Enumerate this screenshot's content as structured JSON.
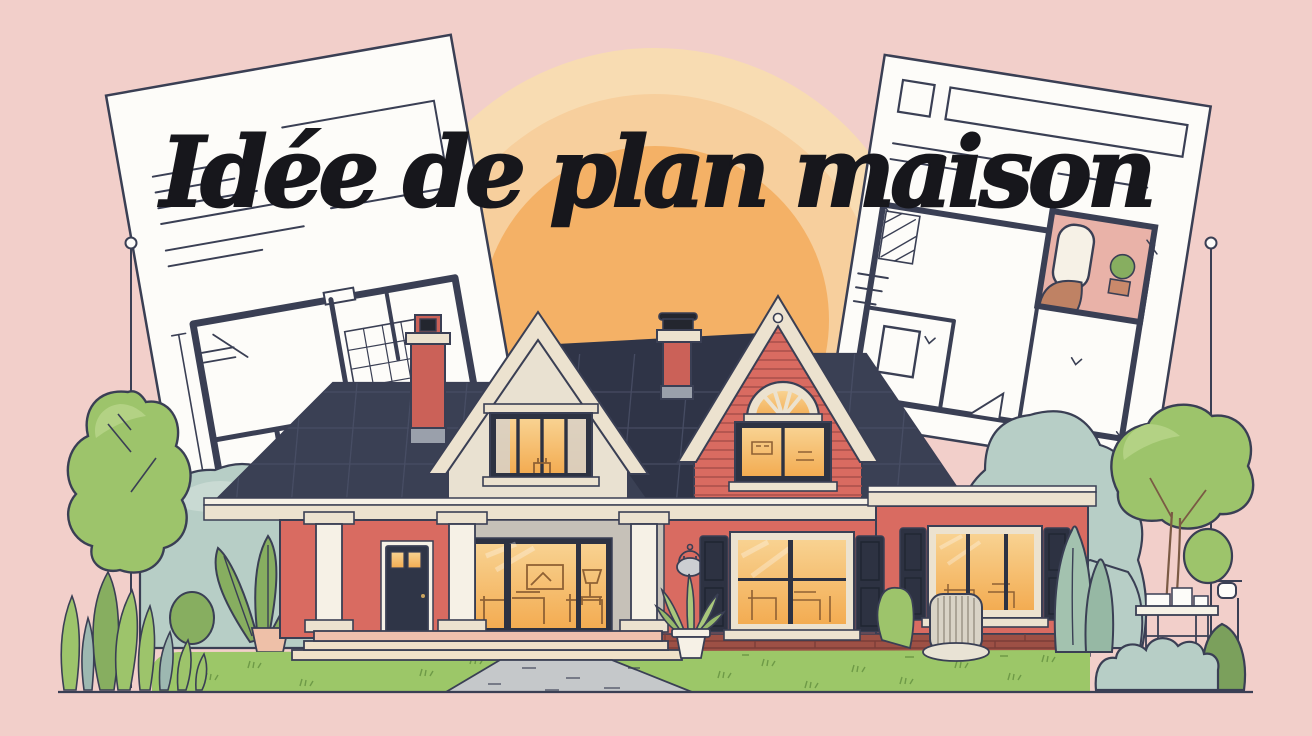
{
  "title": {
    "text": "Idée de plan maison"
  },
  "palette": {
    "bg": "#f2cfca",
    "sun1": "#f8dcb2",
    "sun2": "#f7cf9d",
    "sun3": "#f4b166",
    "ink": "#3a3f54",
    "paper": "#fdfcf9",
    "roof": "#3a4054",
    "roof_dark": "#2f3447",
    "roof_line": "#4b5168",
    "cream": "#ece2cf",
    "cream_light": "#f6f1e6",
    "cream_dark": "#d9cdb5",
    "gable": "#e9e1d1",
    "red": "#d96b61",
    "red_deep": "#c75d55",
    "siding": "#a94f4a",
    "glow": "#f3ac52",
    "glow_light": "#f8d291",
    "frame": "#2d3242",
    "door": "#2f3547",
    "lawn": "#9cc768",
    "lawn_dark": "#6e9a47",
    "green": "#9dc46b",
    "green_hi": "#b3d284",
    "leaf": "#87ae60",
    "sage": "#b7cec6",
    "sage_hi": "#c9dad3",
    "cypress": "#a3c2af",
    "path": "#c5c8ca",
    "step": "#f0e1c9",
    "step_pink": "#efc0ad",
    "brick": "#9d5045",
    "brick_dark": "#7c3e38",
    "bath_pink": "#e9b2a8",
    "chimney": "#cb6158",
    "metal": "#9aa0ab",
    "wicker": "#d9d3c6",
    "furn": "#8f6134",
    "trunk": "#7a5a44",
    "title": "#17171c",
    "pot_pink": "#eec0a8"
  },
  "scene": {
    "sky": "plain pink backdrop",
    "sun": {
      "rings": 3,
      "position": "top center behind title"
    },
    "blueprints": {
      "left": "white floor-plan sheet tilted left with note lines and room plan",
      "right": "white floor-plan sheet tilted right with furnished pink bathroom plan"
    },
    "house": {
      "style": "two-gable cottage with right wing",
      "gables": 2,
      "chimneys": 2,
      "porch_columns": 3,
      "door": "dark navy front door with lit transom panes",
      "windows_lit": 5
    },
    "landscape": [
      "left round tree with survey pin",
      "left sage bushes",
      "leaf plant with pink pot",
      "tall grass blades",
      "lawn with tufts",
      "front steps",
      "concrete walkway",
      "agave in pot",
      "wall sconce",
      "brick foundation",
      "wicker chair",
      "cypress shrubs",
      "right tree with garden table",
      "lamp post",
      "right sage bushes",
      "right survey pin"
    ]
  }
}
